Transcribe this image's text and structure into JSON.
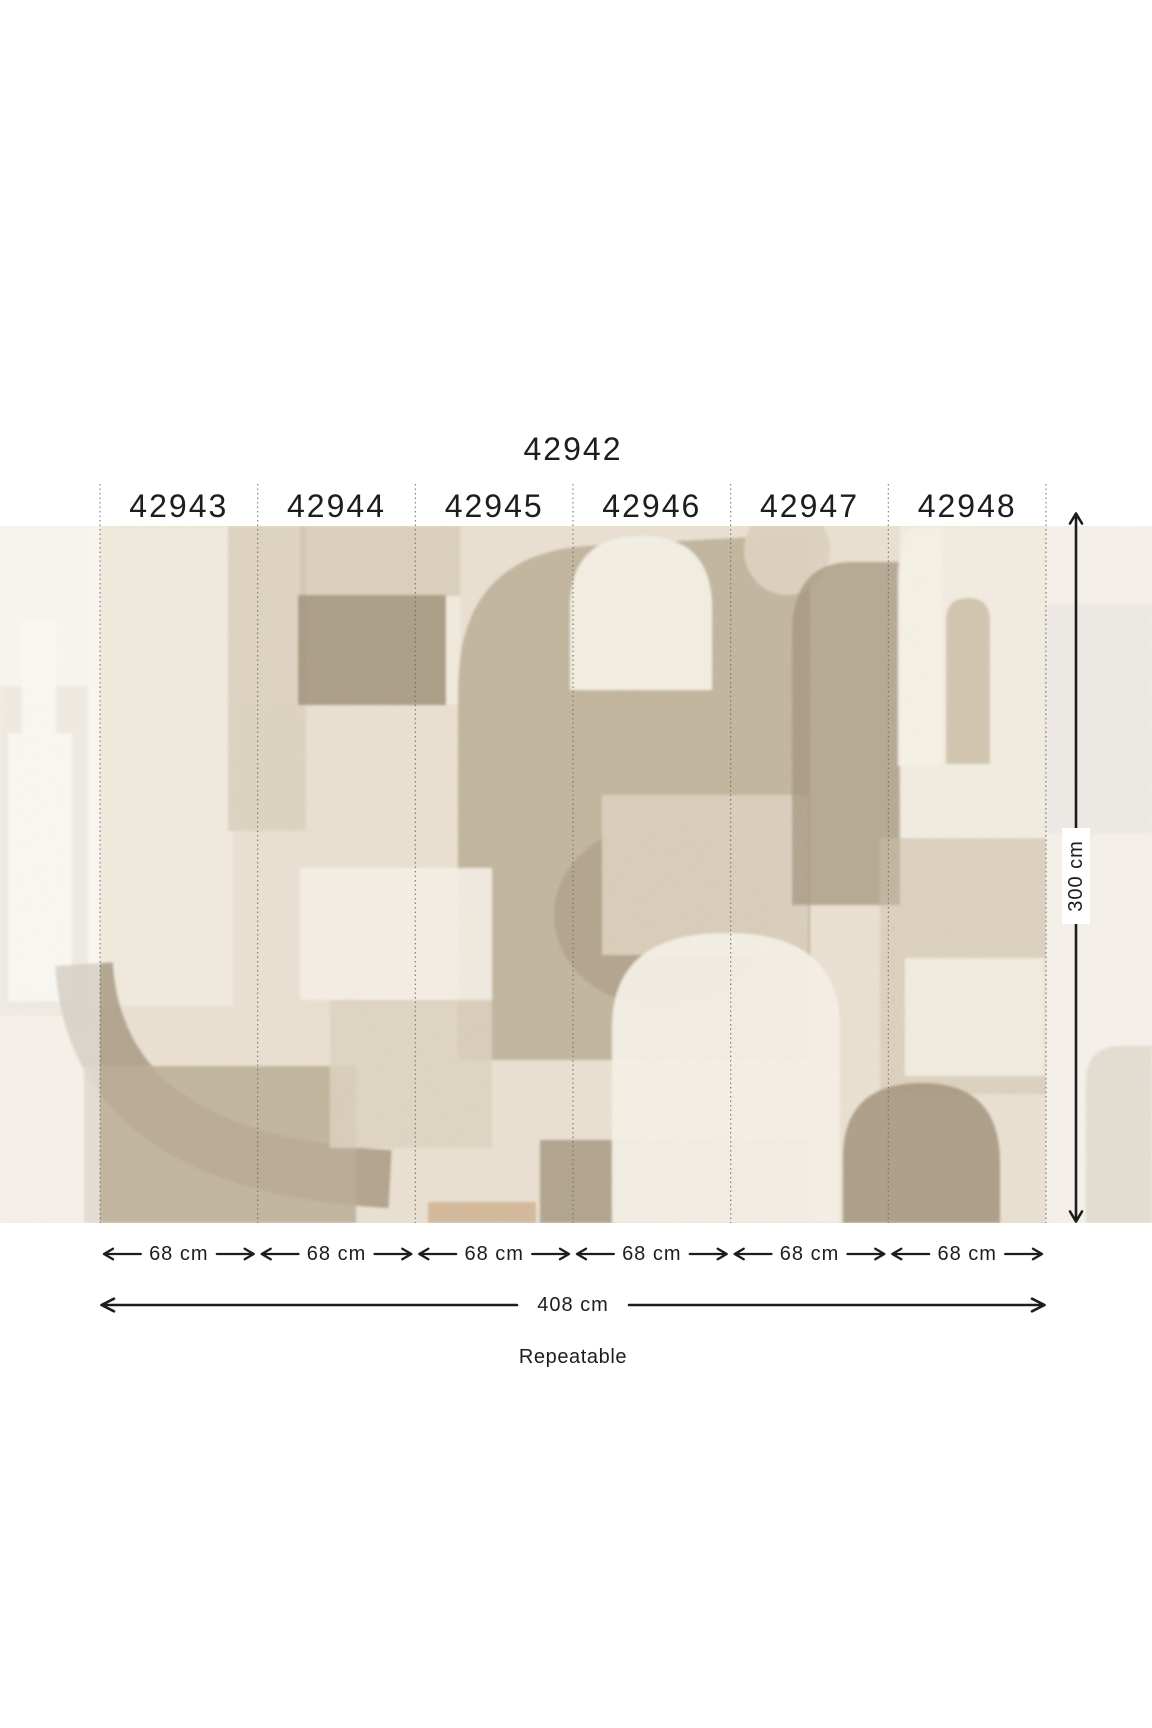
{
  "diagram": {
    "main_code": "42942",
    "panels": [
      {
        "code": "42943",
        "width_label": "68 cm"
      },
      {
        "code": "42944",
        "width_label": "68 cm"
      },
      {
        "code": "42945",
        "width_label": "68 cm"
      },
      {
        "code": "42946",
        "width_label": "68 cm"
      },
      {
        "code": "42947",
        "width_label": "68 cm"
      },
      {
        "code": "42948",
        "width_label": "68 cm"
      },
      {
        "code": "42942",
        "width_label": "68 cm"
      }
    ],
    "total_width_label": "408 cm",
    "height_label": "300 cm",
    "repeat_note": "Repeatable"
  },
  "palette": {
    "page-bg": "#ffffff",
    "text": "#1d1d1d",
    "line": "#1d1d1d",
    "dotted": "#6b6b6b",
    "mural-base": "#eae1d2",
    "cream": "#f1ebde",
    "white-shape": "#f5f0e5",
    "beige-light": "#ddd2bf",
    "beige-mid": "#cfc2ab",
    "taupe-mid": "#bcae96",
    "taupe-dark": "#a3947c",
    "gray-light": "#d9d0c5",
    "ochre": "#c29a6d",
    "fade": "#ffffff"
  }
}
